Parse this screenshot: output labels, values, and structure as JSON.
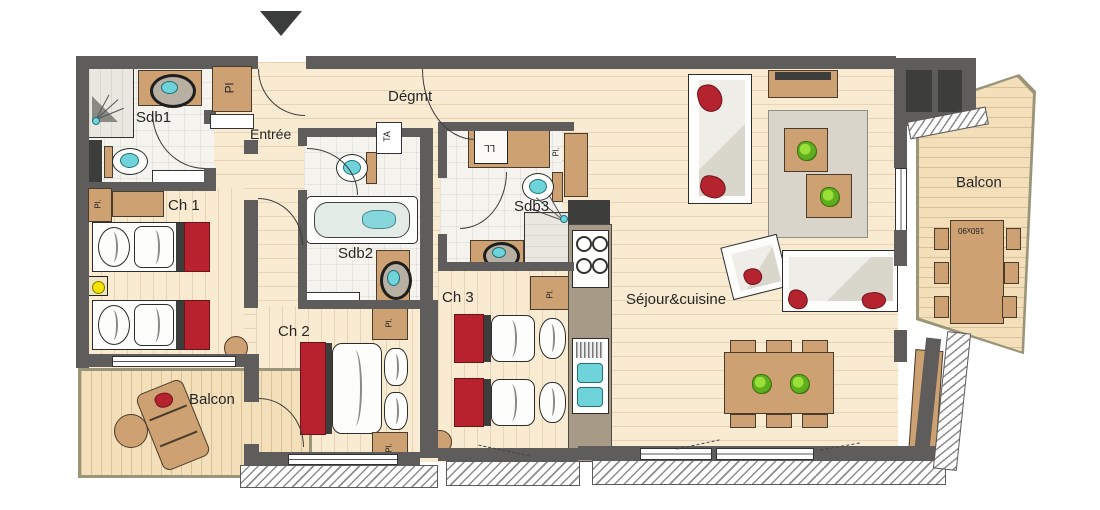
{
  "plan": {
    "rooms": {
      "degmt": "Dégmt",
      "entree": "Entrée",
      "sdb1": "Sdb1",
      "sdb2": "Sdb2",
      "sdb3": "Sdb3",
      "ch1": "Ch 1",
      "ch2": "Ch 2",
      "ch3": "Ch 3",
      "sejour": "Séjour&cuisine",
      "balcon_left": "Balcon",
      "balcon_right": "Balcon"
    },
    "annotations": {
      "closet": "Pl.",
      "closet_sdb1": "Pl",
      "ta": "TA",
      "washing_machine": "LL",
      "table_size": "160x90"
    },
    "colors": {
      "wall": "#5f5d5b",
      "floor": "#f8ebd1",
      "accent_red": "#b7222e",
      "fixture_teal": "#6fd3da",
      "furniture_tan": "#cda172"
    }
  }
}
